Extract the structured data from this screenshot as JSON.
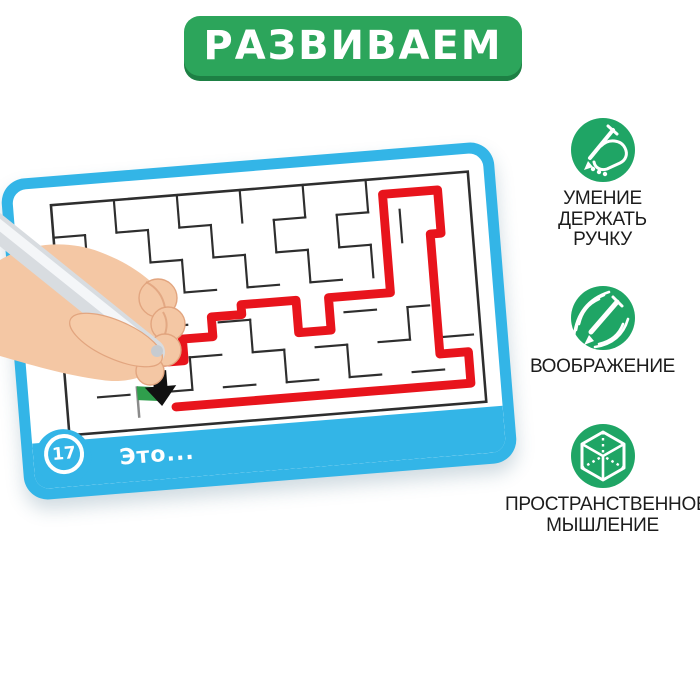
{
  "banner": {
    "label": "РАЗВИВАЕМ"
  },
  "card": {
    "number": "17",
    "caption": "Это..."
  },
  "maze": {
    "bounds": {
      "x": 8,
      "y": 8,
      "w": 424,
      "h": 234
    },
    "wall_color": "#2e2e2e",
    "path_color": "#e8141c",
    "walls": [
      [
        40,
        41,
        40,
        74
      ],
      [
        40,
        107,
        40,
        140
      ],
      [
        72,
        8,
        72,
        41
      ],
      [
        72,
        74,
        72,
        107
      ],
      [
        104,
        41,
        104,
        74
      ],
      [
        136,
        8,
        136,
        41
      ],
      [
        136,
        74,
        136,
        107
      ],
      [
        136,
        173,
        136,
        206
      ],
      [
        168,
        41,
        168,
        74
      ],
      [
        200,
        8,
        200,
        41
      ],
      [
        200,
        74,
        200,
        107
      ],
      [
        200,
        140,
        200,
        173
      ],
      [
        232,
        41,
        232,
        74
      ],
      [
        232,
        173,
        232,
        206
      ],
      [
        264,
        8,
        264,
        41
      ],
      [
        264,
        74,
        264,
        107
      ],
      [
        296,
        41,
        296,
        74
      ],
      [
        296,
        173,
        296,
        206
      ],
      [
        328,
        8,
        328,
        41
      ],
      [
        328,
        74,
        328,
        107
      ],
      [
        360,
        41,
        360,
        74
      ],
      [
        360,
        140,
        360,
        173
      ],
      [
        8,
        41,
        40,
        41
      ],
      [
        72,
        41,
        104,
        41
      ],
      [
        136,
        41,
        168,
        41
      ],
      [
        232,
        41,
        264,
        41
      ],
      [
        296,
        41,
        328,
        41
      ],
      [
        40,
        74,
        72,
        74
      ],
      [
        104,
        74,
        136,
        74
      ],
      [
        168,
        74,
        200,
        74
      ],
      [
        232,
        74,
        264,
        74
      ],
      [
        296,
        74,
        328,
        74
      ],
      [
        8,
        107,
        40,
        107
      ],
      [
        72,
        107,
        104,
        107
      ],
      [
        136,
        107,
        168,
        107
      ],
      [
        200,
        107,
        232,
        107
      ],
      [
        264,
        107,
        296,
        107
      ],
      [
        40,
        140,
        72,
        140
      ],
      [
        104,
        140,
        136,
        140
      ],
      [
        168,
        140,
        200,
        140
      ],
      [
        296,
        140,
        328,
        140
      ],
      [
        360,
        140,
        382,
        140
      ],
      [
        8,
        173,
        40,
        173
      ],
      [
        72,
        173,
        96,
        173
      ],
      [
        136,
        173,
        168,
        173
      ],
      [
        200,
        173,
        232,
        173
      ],
      [
        264,
        173,
        296,
        173
      ],
      [
        328,
        173,
        360,
        173
      ],
      [
        392,
        173,
        424,
        173
      ],
      [
        40,
        206,
        72,
        206
      ],
      [
        104,
        206,
        136,
        206
      ],
      [
        168,
        206,
        200,
        206
      ],
      [
        232,
        206,
        264,
        206
      ],
      [
        296,
        206,
        328,
        206
      ],
      [
        360,
        206,
        392,
        206
      ]
    ],
    "solution_path": [
      [
        100,
        176
      ],
      [
        130,
        176
      ],
      [
        130,
        154
      ],
      [
        161,
        154
      ],
      [
        161,
        134
      ],
      [
        192,
        134
      ],
      [
        192,
        124
      ],
      [
        248,
        124
      ],
      [
        248,
        157
      ],
      [
        281,
        157
      ],
      [
        281,
        124
      ],
      [
        344,
        124
      ],
      [
        344,
        24
      ],
      [
        400,
        24
      ],
      [
        400,
        68
      ],
      [
        389,
        68
      ],
      [
        389,
        190
      ],
      [
        418,
        190
      ],
      [
        418,
        222
      ],
      [
        118,
        222
      ]
    ],
    "flag": {
      "x": 80,
      "top": 198,
      "w": 24,
      "h": 14,
      "pole_bottom": 230,
      "color": "#2f9e4c"
    },
    "arrow": {
      "cx": 104,
      "top": 184,
      "color": "#111111"
    }
  },
  "features": [
    {
      "icon": "hand-holding-pen-icon",
      "lines": [
        "УМЕНИЕ",
        "ДЕРЖАТЬ",
        "РУЧКУ"
      ]
    },
    {
      "icon": "imagination-pencil-icon",
      "lines": [
        "ВООБРАЖЕНИЕ"
      ]
    },
    {
      "icon": "spatial-thinking-cube-icon",
      "lines": [
        "ПРОСТРАНСТВЕННОЕ",
        "МЫШЛЕНИЕ"
      ]
    }
  ],
  "colors": {
    "banner_green": "#2ca55b",
    "banner_edge": "#1d8044",
    "icon_green": "#1fa565",
    "card_blue": "#33b5e7",
    "path_red": "#e8141c",
    "text_black": "#1c1c1c"
  }
}
